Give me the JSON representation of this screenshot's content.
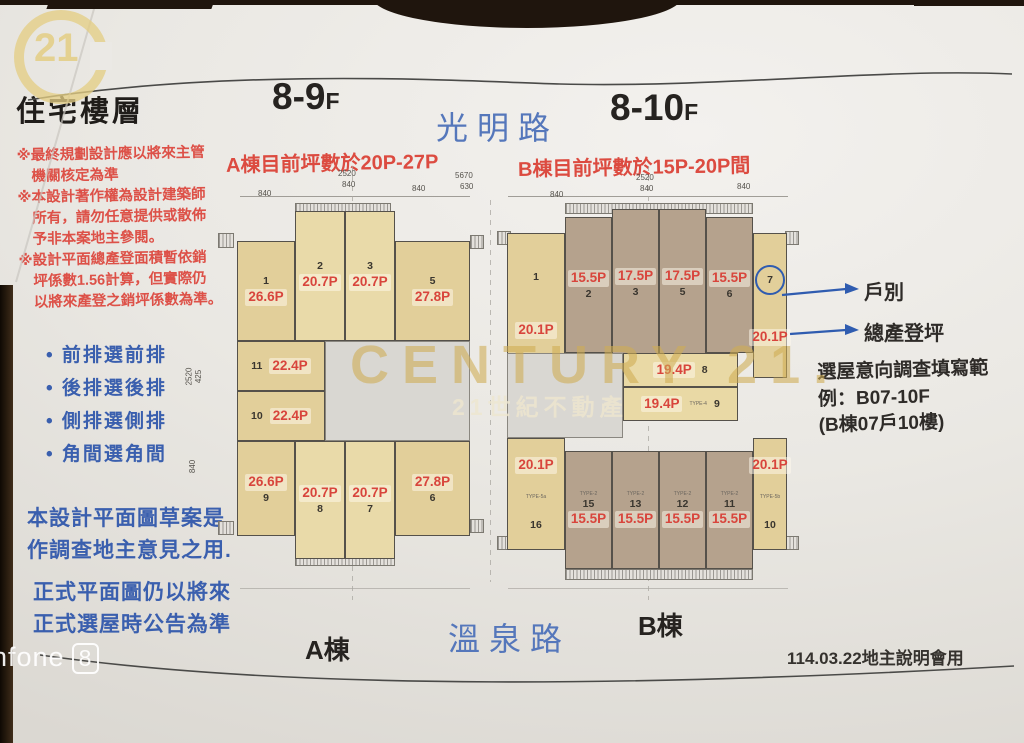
{
  "header": {
    "floors_a": "8-9",
    "floors_a_f": "F",
    "floors_b": "8-10",
    "floors_b_f": "F",
    "road_top": "光明路",
    "range_a": "A棟目前坪數於20P-27P",
    "range_b": "B棟目前坪數於15P-20P間"
  },
  "left_panel": {
    "title": "住宅樓層",
    "notes": "※最終規劃設計應以將來主管\n　機關核定為準\n※本設計著作權為設計建築師\n　所有，請勿任意提供或散佈\n　予非本案地主參閱。\n※設計平面總產登面積暫依銷\n　坪係數1.56計算，但實際仍\n　以將來產登之銷坪係數為準。",
    "bullets": [
      "• 前排選前排",
      "• 後排選後排",
      "• 側排選側排",
      "• 角間選角間"
    ],
    "draft_note": "本設計平面圖草案是\n作調查地主意見之用.",
    "final_note": "正式平面圖仍以將來\n正式選屋時公告為準"
  },
  "plans": {
    "a": {
      "label": "A棟",
      "units": [
        {
          "no": "1",
          "area": "26.6P"
        },
        {
          "no": "2",
          "area": "20.7P"
        },
        {
          "no": "3",
          "area": "20.7P"
        },
        {
          "no": "5",
          "area": "27.8P"
        },
        {
          "no": "11",
          "area": "22.4P"
        },
        {
          "no": "10",
          "area": "22.4P"
        },
        {
          "no": "9",
          "area": "26.6P"
        },
        {
          "no": "8",
          "area": "20.7P"
        },
        {
          "no": "7",
          "area": "20.7P"
        },
        {
          "no": "6",
          "area": "27.8P"
        }
      ]
    },
    "b": {
      "label": "B棟",
      "units": [
        {
          "no": "1",
          "area": "20.1P"
        },
        {
          "no": "2",
          "area": "15.5P"
        },
        {
          "no": "3",
          "area": "17.5P"
        },
        {
          "no": "5",
          "area": "17.5P"
        },
        {
          "no": "6",
          "area": "15.5P"
        },
        {
          "no": "7",
          "area": "20.1P"
        },
        {
          "no": "8",
          "area": "19.4P"
        },
        {
          "no": "9",
          "area": "19.4P",
          "type": "TYPE-4"
        },
        {
          "no": "16",
          "area": "20.1P",
          "type": "TYPE-5a"
        },
        {
          "no": "15",
          "area": "15.5P",
          "type": "TYPE-2"
        },
        {
          "no": "13",
          "area": "15.5P",
          "type": "TYPE-2"
        },
        {
          "no": "12",
          "area": "15.5P",
          "type": "TYPE-2"
        },
        {
          "no": "11",
          "area": "15.5P",
          "type": "TYPE-2"
        },
        {
          "no": "10",
          "area": "20.1P",
          "type": "TYPE-5b"
        }
      ]
    }
  },
  "dims": {
    "a": {
      "total": "2520",
      "center": "840",
      "left": "840",
      "right": "840",
      "side_upper": "2520",
      "side_mid": "425",
      "side_lower": "840"
    },
    "b": {
      "total": "2520",
      "center": "840",
      "left": "840",
      "right": "840"
    },
    "between": {
      "outer": "5670",
      "inner": "630"
    }
  },
  "annotations": {
    "unit_no_label": "戶別",
    "area_label": "總產登坪",
    "survey": "選屋意向調查填寫範\n例：B07-10F\n(B棟07戶10樓)"
  },
  "footer": {
    "building_a": "A棟",
    "road_bottom": "溫泉路",
    "building_b": "B棟",
    "date_note": "114.03.22地主說明會用"
  },
  "watermarks": {
    "brand": "CENTURY 21.",
    "brand_sub": "21世紀不動產",
    "logo_number": "21",
    "camera": "nfone",
    "camera_number": "8"
  },
  "colors": {
    "note_red": "#dd5148",
    "label_red": "#d8453c",
    "text_blue": "#3a5fae",
    "road_blue": "#5577bb",
    "gold": "#cdab52",
    "khaki_unit": "#e2cf9a",
    "brown_unit": "#b5a28d",
    "table_brown": "#1f150d"
  }
}
